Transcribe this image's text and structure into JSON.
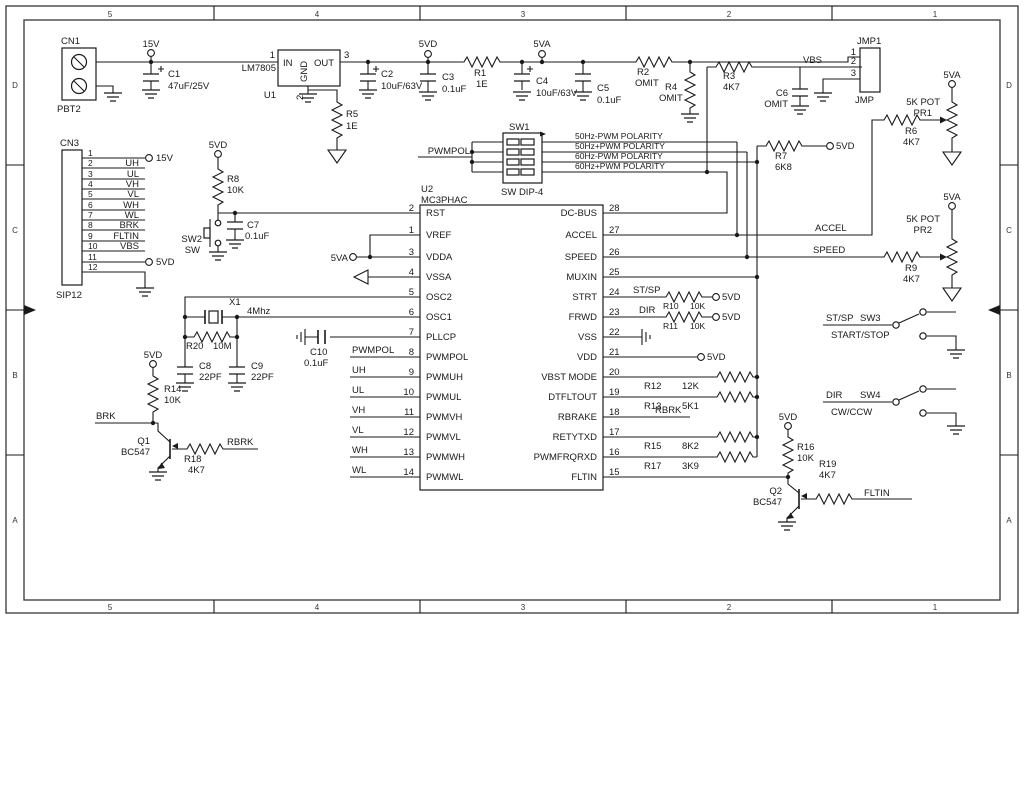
{
  "nets": {
    "v15": "15V",
    "v5d": "5VD",
    "v5a": "5VA",
    "vbs": "VBS",
    "pwmpol": "PWMPOL",
    "uh": "UH",
    "ul": "UL",
    "vh": "VH",
    "vl": "VL",
    "wh": "WH",
    "wl": "WL",
    "brk": "BRK",
    "rbrk": "RBRK",
    "fltin": "FLTIN",
    "stsp": "ST/SP",
    "dir": "DIR",
    "accel": "ACCEL",
    "speed": "SPEED"
  },
  "border": {
    "cols": [
      "5",
      "4",
      "3",
      "2",
      "1"
    ],
    "rows": [
      "D",
      "C",
      "B",
      "A"
    ]
  },
  "power": {
    "cn1": {
      "ref": "CN1",
      "part": "PBT2"
    },
    "c1": {
      "ref": "C1",
      "val": "47uF/25V"
    },
    "u1": {
      "ref": "U1",
      "part": "LM7805",
      "pin_in": "IN",
      "pin_gnd": "GND",
      "pin_out": "OUT",
      "n_in": "1",
      "n_gnd": "2",
      "n_out": "3"
    },
    "r5": {
      "ref": "R5",
      "val": "1E"
    },
    "c2": {
      "ref": "C2",
      "val": "10uF/63V"
    },
    "c3": {
      "ref": "C3",
      "val": "0.1uF"
    },
    "r1": {
      "ref": "R1",
      "val": "1E"
    },
    "c4": {
      "ref": "C4",
      "val": "10uF/63V"
    },
    "c5": {
      "ref": "C5",
      "val": "0.1uF"
    },
    "r2": {
      "ref": "R2",
      "val": "OMIT"
    },
    "r4": {
      "ref": "R4",
      "val": "OMIT"
    },
    "r3": {
      "ref": "R3",
      "val": "4K7"
    },
    "c6": {
      "ref": "C6",
      "val": "OMIT"
    },
    "r7": {
      "ref": "R7",
      "val": "6K8"
    },
    "jmp1": {
      "ref": "JMP1",
      "part": "JMP",
      "p1": "1",
      "p2": "2",
      "p3": "3"
    }
  },
  "cn3": {
    "ref": "CN3",
    "part": "SIP12",
    "pins": [
      {
        "n": "1",
        "net": ""
      },
      {
        "n": "2",
        "net": "UH"
      },
      {
        "n": "3",
        "net": "UL"
      },
      {
        "n": "4",
        "net": "VH"
      },
      {
        "n": "5",
        "net": "VL"
      },
      {
        "n": "6",
        "net": "WH"
      },
      {
        "n": "7",
        "net": "WL"
      },
      {
        "n": "8",
        "net": "BRK"
      },
      {
        "n": "9",
        "net": "FLTIN"
      },
      {
        "n": "10",
        "net": "VBS"
      },
      {
        "n": "11",
        "net": ""
      },
      {
        "n": "12",
        "net": ""
      }
    ]
  },
  "reset": {
    "r8": {
      "ref": "R8",
      "val": "10K"
    },
    "c7": {
      "ref": "C7",
      "val": "0.1uF"
    },
    "sw2": {
      "ref": "SW2",
      "part": "SW"
    }
  },
  "osc": {
    "x1": {
      "ref": "X1",
      "val": "4Mhz"
    },
    "r20": {
      "ref": "R20",
      "val": "10M"
    },
    "c8": {
      "ref": "C8",
      "val": "22PF"
    },
    "c9": {
      "ref": "C9",
      "val": "22PF"
    },
    "c10": {
      "ref": "C10",
      "val": "0.1uF"
    }
  },
  "u2": {
    "ref": "U2",
    "part": "MC3PHAC",
    "left": [
      {
        "n": "2",
        "name": "RST"
      },
      {
        "n": "1",
        "name": "VREF"
      },
      {
        "n": "3",
        "name": "VDDA"
      },
      {
        "n": "4",
        "name": "VSSA"
      },
      {
        "n": "5",
        "name": "OSC2"
      },
      {
        "n": "6",
        "name": "OSC1"
      },
      {
        "n": "7",
        "name": "PLLCP"
      },
      {
        "n": "8",
        "name": "PWMPOL"
      },
      {
        "n": "9",
        "name": "PWMUH"
      },
      {
        "n": "10",
        "name": "PWMUL"
      },
      {
        "n": "11",
        "name": "PWMVH"
      },
      {
        "n": "12",
        "name": "PWMVL"
      },
      {
        "n": "13",
        "name": "PWMWH"
      },
      {
        "n": "14",
        "name": "PWMWL"
      }
    ],
    "right": [
      {
        "n": "28",
        "name": "DC-BUS"
      },
      {
        "n": "27",
        "name": "ACCEL"
      },
      {
        "n": "26",
        "name": "SPEED"
      },
      {
        "n": "25",
        "name": "MUXIN"
      },
      {
        "n": "24",
        "name": "STRT"
      },
      {
        "n": "23",
        "name": "FRWD"
      },
      {
        "n": "22",
        "name": "VSS"
      },
      {
        "n": "21",
        "name": "VDD"
      },
      {
        "n": "20",
        "name": "VBST MODE"
      },
      {
        "n": "19",
        "name": "DTFLTOUT"
      },
      {
        "n": "18",
        "name": "RBRAKE"
      },
      {
        "n": "17",
        "name": "RETYTXD"
      },
      {
        "n": "16",
        "name": "PWMFRQRXD"
      },
      {
        "n": "15",
        "name": "FLTIN"
      }
    ]
  },
  "sw1": {
    "ref": "SW1",
    "part": "SW DIP-4",
    "rows": [
      "50Hz-PWM POLARITY",
      "50Hz+PWM POLARITY",
      "60Hz-PWM POLARITY",
      "60Hz+PWM POLARITY"
    ]
  },
  "pullups": {
    "r10": {
      "ref": "R10",
      "val": "10K"
    },
    "r11": {
      "ref": "R11",
      "val": "10K"
    },
    "r12": {
      "ref": "R12",
      "val": "12K"
    },
    "r13": {
      "ref": "R13",
      "val": "5K1"
    },
    "r15": {
      "ref": "R15",
      "val": "8K2"
    },
    "r17": {
      "ref": "R17",
      "val": "3K9"
    }
  },
  "analog": {
    "pr1": {
      "ref": "PR1",
      "val": "5K POT"
    },
    "r6": {
      "ref": "R6",
      "val": "4K7"
    },
    "pr2": {
      "ref": "PR2",
      "val": "5K POT"
    },
    "r9": {
      "ref": "R9",
      "val": "4K7"
    }
  },
  "control": {
    "sw3": {
      "ref": "SW3",
      "desc": "START/STOP"
    },
    "sw4": {
      "ref": "SW4",
      "desc": "CW/CCW"
    }
  },
  "brake": {
    "q1": {
      "ref": "Q1",
      "part": "BC547"
    },
    "r14": {
      "ref": "R14",
      "val": "10K"
    },
    "r18": {
      "ref": "R18",
      "val": "4K7"
    }
  },
  "fault": {
    "q2": {
      "ref": "Q2",
      "part": "BC547"
    },
    "r16": {
      "ref": "R16",
      "val": "10K"
    },
    "r19": {
      "ref": "R19",
      "val": "4K7"
    }
  }
}
